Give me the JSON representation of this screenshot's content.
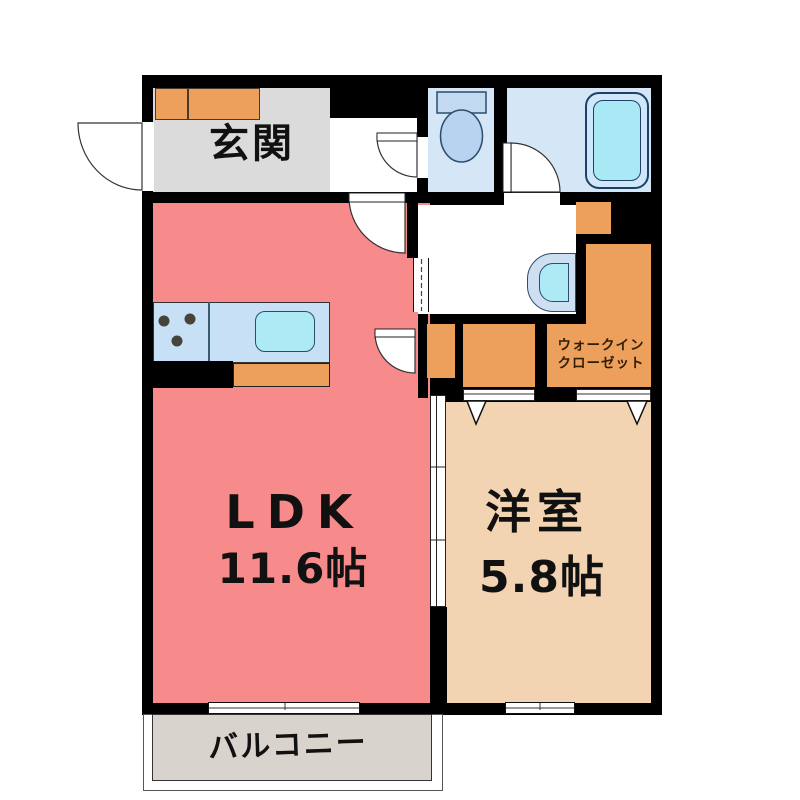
{
  "plan_title": "1LDK apartment floor plan",
  "rooms": {
    "entrance": {
      "label": "玄関"
    },
    "ldk": {
      "label": "LDK",
      "size": "11.6帖"
    },
    "western": {
      "label": "洋室",
      "size": "5.8帖"
    },
    "wic": {
      "line1": "ウォークイン",
      "line2": "クローゼット"
    },
    "balcony": {
      "label": "バルコニー"
    }
  },
  "colors": {
    "wall": "#000000",
    "ldk_floor": "#f78a8b",
    "western_floor": "#f3d4b2",
    "closet_orange": "#eca05c",
    "entrance_floor": "#dbdbdb",
    "balcony_floor": "#d8d3cc",
    "wet_room_blue": "#d5e6f7",
    "counter_blue": "#c8e0f5",
    "fixture_cyan": "#aeeaf5",
    "wic_text": "#2f1d05"
  },
  "fixtures": {
    "icons": [
      "toilet-icon",
      "bathtub-icon",
      "washbasin-icon",
      "kitchen-sink-icon",
      "stove-burners-icon",
      "door-swing-icon",
      "sliding-door-icon",
      "window-icon"
    ]
  }
}
